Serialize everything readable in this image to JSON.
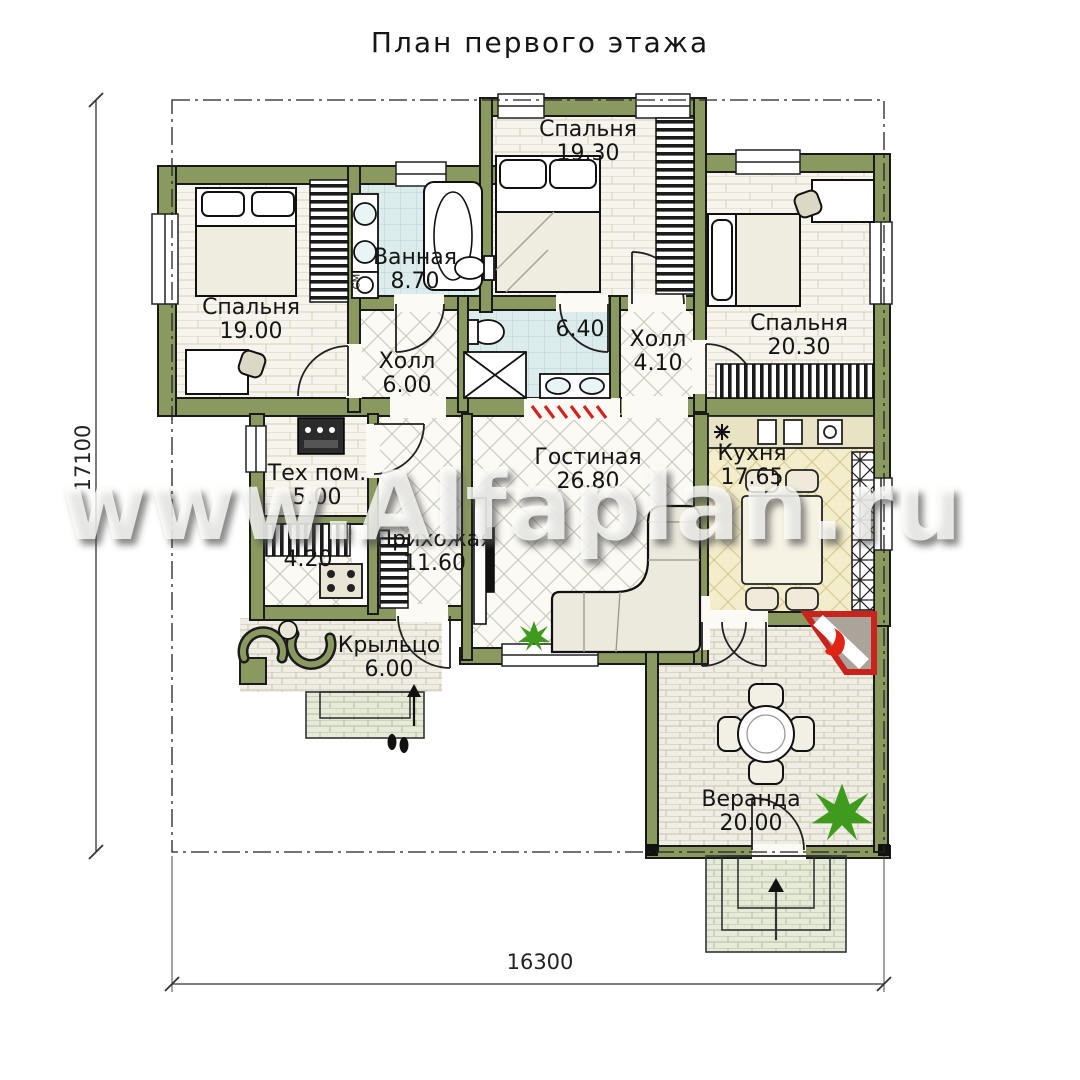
{
  "title": "План первого этажа",
  "watermark": "www.Alfaplan.ru",
  "dimensions": {
    "overall_height": "17100",
    "overall_width": "16300"
  },
  "rooms": [
    {
      "name": "Спальня",
      "area": "19.30"
    },
    {
      "name": "Спальня",
      "area": "19.00"
    },
    {
      "name": "Ванная",
      "area": "8.70"
    },
    {
      "name": "",
      "area": "6.40"
    },
    {
      "name": "Холл",
      "area": "6.00"
    },
    {
      "name": "Холл",
      "area": "4.10"
    },
    {
      "name": "Спальня",
      "area": "20.30"
    },
    {
      "name": "Тех пом.",
      "area": "5.00"
    },
    {
      "name": "",
      "area": "4.20"
    },
    {
      "name": "Прихожая",
      "area": "11.60"
    },
    {
      "name": "Гостиная",
      "area": "26.80"
    },
    {
      "name": "Кухня",
      "area": "17.65"
    },
    {
      "name": "Крыльцо",
      "area": "6.00"
    },
    {
      "name": "Веранда",
      "area": "20.00"
    }
  ],
  "small_labels": {
    "washer": "СМ"
  },
  "colors": {
    "wall_olive": "#8a9960",
    "bath_tile": "#dcecec",
    "kitchen_floor": "#f4edcb",
    "accent_red": "#cc2019",
    "plant_green": "#3f9b1e"
  }
}
